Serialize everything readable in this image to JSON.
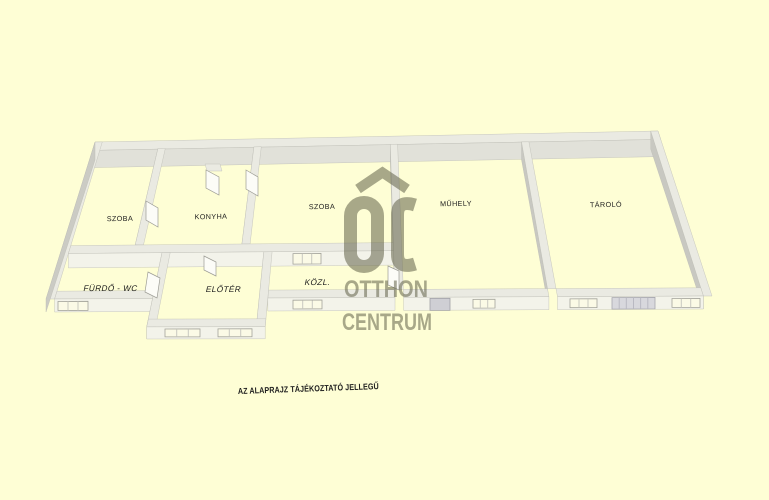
{
  "page": {
    "background_color": "#fefed5",
    "type_note": "3D floorplan render"
  },
  "rooms": [
    {
      "id": "szoba-1",
      "label": "SZOBA"
    },
    {
      "id": "konyha",
      "label": "KONYHA"
    },
    {
      "id": "szoba-2",
      "label": "SZOBA"
    },
    {
      "id": "muhely",
      "label": "MŰHELY"
    },
    {
      "id": "tarolo",
      "label": "TÁROLÓ"
    },
    {
      "id": "furdo-wc",
      "label": "FÜRDŐ - WC"
    },
    {
      "id": "eloter",
      "label": "ELŐTÉR"
    },
    {
      "id": "kozl",
      "label": "KÖZL."
    }
  ],
  "watermark": {
    "logo_initials": "ŐC",
    "line1": "OTTHON",
    "line2": "CENTRUM",
    "color": "#63634a"
  },
  "disclaimer": "AZ ALAPRAJZ TÁJÉKOZTATÓ JELLEGŰ",
  "colors": {
    "wall_top": "#eaeae2",
    "wall_bright": "#f3f3ea",
    "wall_shade": "#c8c8c1",
    "window_glass": "#fbfae6",
    "label_text": "#1b1b1b"
  }
}
